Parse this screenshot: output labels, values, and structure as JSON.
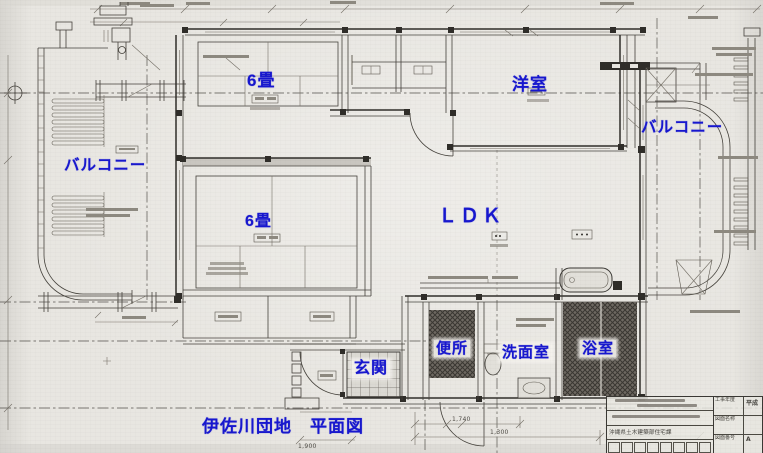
{
  "page": {
    "type": "scanned architectural floor plan",
    "sheet_caption": "伊佐川団地　平面図"
  },
  "room_labels": {
    "balcony_left": "バルコニー",
    "tatami_upper": "6畳",
    "western_room": "洋室",
    "balcony_right": "バルコニー",
    "tatami_lower": "6畳",
    "ldk": "ＬＤＫ",
    "entrance": "玄関",
    "toilet": "便所",
    "washroom": "洗面室",
    "bathroom": "浴室"
  },
  "caption": {
    "text": "伊佐川団地　平面図"
  },
  "title_block": {
    "agency": "沖縄県土木建築部住宅課",
    "fields": [
      {
        "label": "工事年度",
        "value": "平成"
      },
      {
        "label": "図面名称",
        "value": ""
      },
      {
        "label": "図面番号",
        "value": "A"
      }
    ]
  },
  "dimension_texts": [
    "1,740",
    "1,300",
    "1,900"
  ],
  "colors": {
    "label_blue": "#1717cf",
    "paper": "#e7e5e0",
    "ink": "#45423c"
  }
}
